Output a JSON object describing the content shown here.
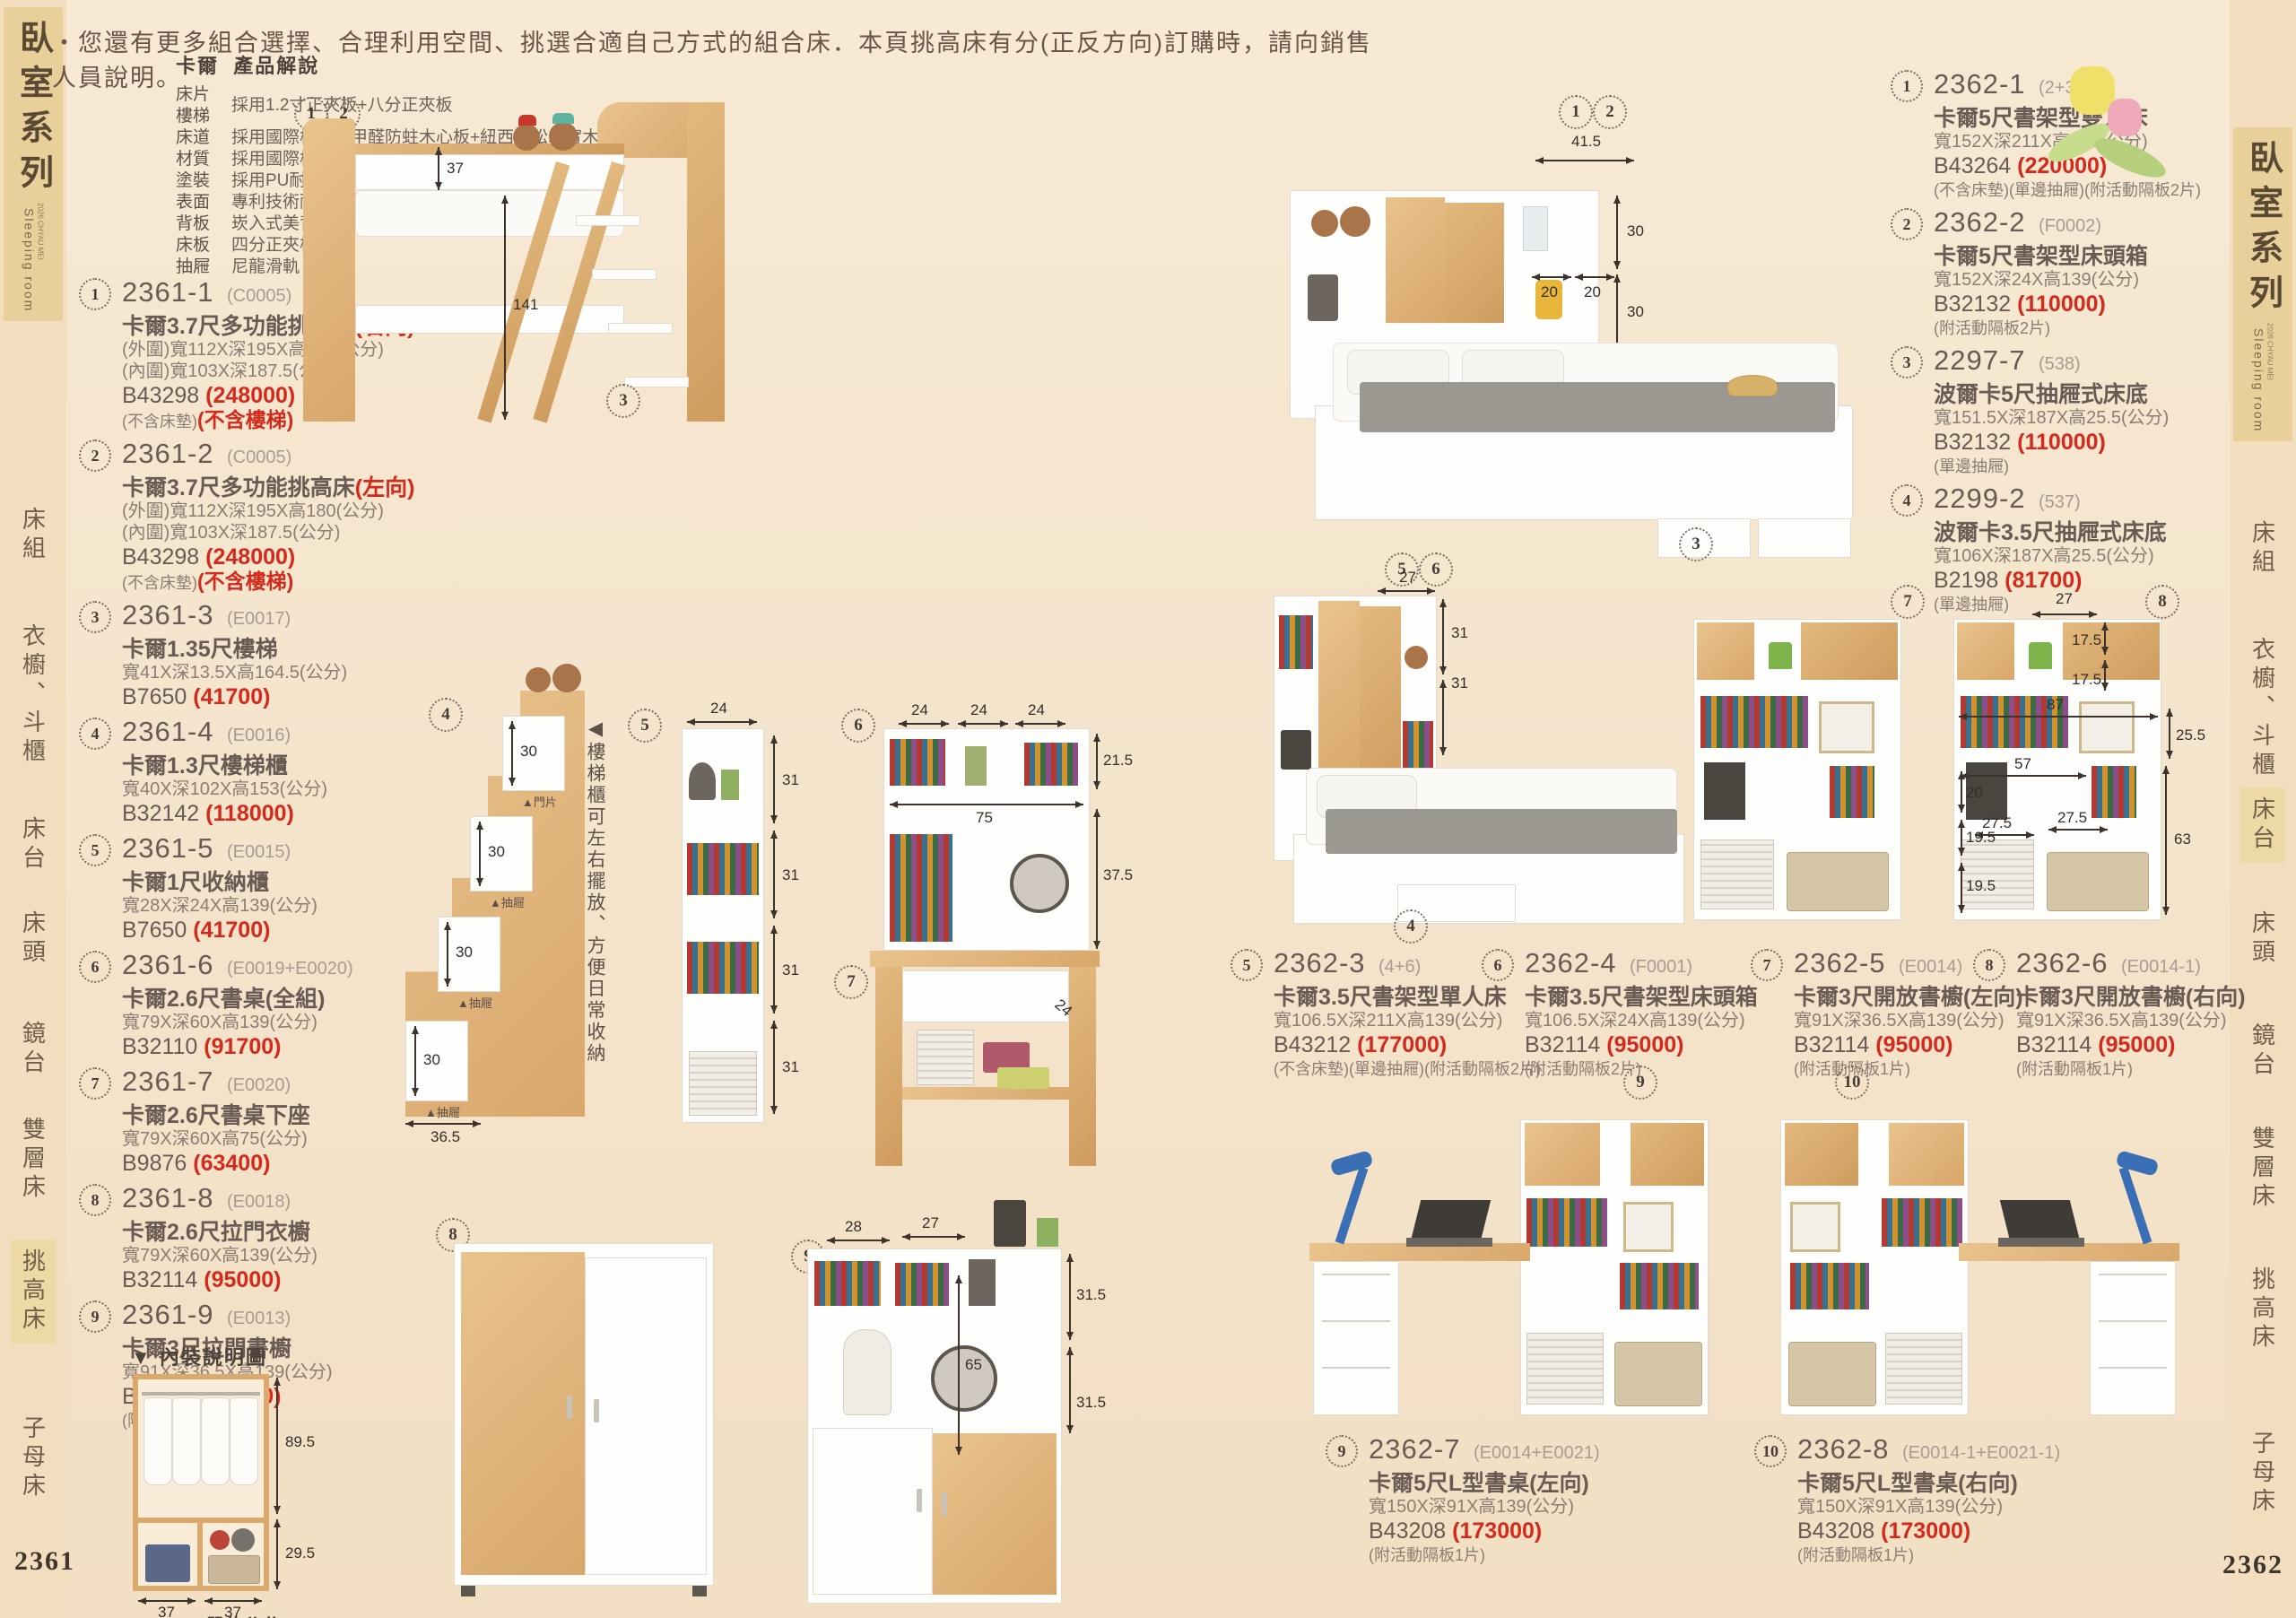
{
  "meta": {
    "header_note": "・您還有更多組合選擇、合理利用空間、挑選合適自己方式的組合床．本頁挑高床有分(正反方向)訂購時，請向銷售人員說明。",
    "page_left": "2361",
    "page_right": "2362"
  },
  "sidebar_left": {
    "series_title": "臥室系列",
    "series_subtitle": "Sleeping room",
    "series_edition": "2026 CHYAU MEI",
    "items": [
      "床組",
      "衣櫥、斗櫃",
      "床台",
      "床頭",
      "鏡台",
      "雙層床",
      "挑高床",
      "子母床"
    ],
    "active": "挑高床"
  },
  "sidebar_right": {
    "series_title": "臥室系列",
    "series_subtitle": "Sleeping room",
    "series_edition": "2026 CHYAU MEI",
    "items": [
      "床組",
      "衣櫥、斗櫃",
      "床台",
      "床頭",
      "鏡台",
      "雙層床",
      "挑高床",
      "子母床"
    ],
    "active": "床台"
  },
  "spec_block": {
    "brand": "卡爾",
    "title": "產品解說",
    "first_label_a": "床片",
    "first_label_b": "樓梯",
    "first_value": "採用1.2寸正夾板+八分正夾板",
    "rows": [
      {
        "label": "床道",
        "value": "採用國際標準低甲醛防蛀木心板+紐西蘭松木實木"
      },
      {
        "label": "材質",
        "value": "採用國際標準低甲醛防蛀木心板"
      },
      {
        "label": "塗裝",
        "value": "採用PU耐磨.耐水塗裝"
      },
      {
        "label": "表面",
        "value": "專利技術耐磨木紋同調浮雕壓紋.觸感猶如實木"
      },
      {
        "label": "背板",
        "value": "崁入式美背處理"
      },
      {
        "label": "床板",
        "value": "四分正夾板"
      },
      {
        "label": "抽屜",
        "value": "尼龍滑軌"
      }
    ]
  },
  "products_left": [
    {
      "num": "1",
      "code": "2361-1",
      "ref": "(C0005)",
      "name": "卡爾3.7尺多功能挑高床",
      "name_red": "(右向)",
      "dims": [
        "(外圍)寬112X深195X高180(公分)",
        "(內圍)寬103X深187.5(公分)"
      ],
      "sku": "B43298",
      "price": "(248000)",
      "note": "(不含床墊)",
      "note_red": "(不含樓梯)"
    },
    {
      "num": "2",
      "code": "2361-2",
      "ref": "(C0005)",
      "name": "卡爾3.7尺多功能挑高床",
      "name_red": "(左向)",
      "dims": [
        "(外圍)寬112X深195X高180(公分)",
        "(內圍)寬103X深187.5(公分)"
      ],
      "sku": "B43298",
      "price": "(248000)",
      "note": "(不含床墊)",
      "note_red": "(不含樓梯)"
    },
    {
      "num": "3",
      "code": "2361-3",
      "ref": "(E0017)",
      "name": "卡爾1.35尺樓梯",
      "dims": [
        "寬41X深13.5X高164.5(公分)"
      ],
      "sku": "B7650",
      "price": "(41700)"
    },
    {
      "num": "4",
      "code": "2361-4",
      "ref": "(E0016)",
      "name": "卡爾1.3尺樓梯櫃",
      "dims": [
        "寬40X深102X高153(公分)"
      ],
      "sku": "B32142",
      "price": "(118000)"
    },
    {
      "num": "5",
      "code": "2361-5",
      "ref": "(E0015)",
      "name": "卡爾1尺收納櫃",
      "dims": [
        "寬28X深24X高139(公分)"
      ],
      "sku": "B7650",
      "price": "(41700)"
    },
    {
      "num": "6",
      "code": "2361-6",
      "ref": "(E0019+E0020)",
      "name": "卡爾2.6尺書桌(全組)",
      "dims": [
        "寬79X深60X高139(公分)"
      ],
      "sku": "B32110",
      "price": "(91700)"
    },
    {
      "num": "7",
      "code": "2361-7",
      "ref": "(E0020)",
      "name": "卡爾2.6尺書桌下座",
      "dims": [
        "寬79X深60X高75(公分)"
      ],
      "sku": "B9876",
      "price": "(63400)"
    },
    {
      "num": "8",
      "code": "2361-8",
      "ref": "(E0018)",
      "name": "卡爾2.6尺拉門衣櫥",
      "dims": [
        "寬79X深60X高139(公分)"
      ],
      "sku": "B32114",
      "price": "(95000)"
    },
    {
      "num": "9",
      "code": "2361-9",
      "ref": "(E0013)",
      "name": "卡爾3尺拉門書櫥",
      "dims": [
        "寬91X深36.5X高139(公分)"
      ],
      "sku": "B32112",
      "price": "(93300)",
      "note": "(附活動隔板1片)"
    }
  ],
  "products_right": [
    {
      "num": "1",
      "code": "2362-1",
      "ref": "(2+3)",
      "name": "卡爾5尺書架型雙人床",
      "dims": [
        "寬152X深211X高139(公分)"
      ],
      "sku": "B43264",
      "price": "(220000)",
      "note": "(不含床墊)(單邊抽屜)(附活動隔板2片)"
    },
    {
      "num": "2",
      "code": "2362-2",
      "ref": "(F0002)",
      "name": "卡爾5尺書架型床頭箱",
      "dims": [
        "寬152X深24X高139(公分)"
      ],
      "sku": "B32132",
      "price": "(110000)",
      "note": "(附活動隔板2片)"
    },
    {
      "num": "3",
      "code": "2297-7",
      "ref": "(538)",
      "name": "波爾卡5尺抽屜式床底",
      "dims": [
        "寬151.5X深187X高25.5(公分)"
      ],
      "sku": "B32132",
      "price": "(110000)",
      "note": "(單邊抽屜)"
    },
    {
      "num": "4",
      "code": "2299-2",
      "ref": "(537)",
      "name": "波爾卡3.5尺抽屜式床底",
      "dims": [
        "寬106X深187X高25.5(公分)"
      ],
      "sku": "B2198",
      "price": "(81700)",
      "note": "(單邊抽屜)"
    }
  ],
  "products_mid": [
    {
      "num": "5",
      "code": "2362-3",
      "ref": "(4+6)",
      "name": "卡爾3.5尺書架型單人床",
      "dims": [
        "寬106.5X深211X高139(公分)"
      ],
      "sku": "B43212",
      "price": "(177000)",
      "note": "(不含床墊)(單邊抽屜)(附活動隔板2片)"
    },
    {
      "num": "6",
      "code": "2362-4",
      "ref": "(F0001)",
      "name": "卡爾3.5尺書架型床頭箱",
      "dims": [
        "寬106.5X深24X高139(公分)"
      ],
      "sku": "B32114",
      "price": "(95000)",
      "note": "(附活動隔板2片)"
    },
    {
      "num": "7",
      "code": "2362-5",
      "ref": "(E0014)",
      "name": "卡爾3尺開放書櫥(左向)",
      "dims": [
        "寬91X深36.5X高139(公分)"
      ],
      "sku": "B32114",
      "price": "(95000)",
      "note": "(附活動隔板1片)"
    },
    {
      "num": "8",
      "code": "2362-6",
      "ref": "(E0014-1)",
      "name": "卡爾3尺開放書櫥(右向)",
      "dims": [
        "寬91X深36.5X高139(公分)"
      ],
      "sku": "B32114",
      "price": "(95000)",
      "note": "(附活動隔板1片)"
    }
  ],
  "products_bottom": [
    {
      "num": "9",
      "code": "2362-7",
      "ref": "(E0014+E0021)",
      "name": "卡爾5尺L型書桌(左向)",
      "dims": [
        "寬150X深91X高139(公分)"
      ],
      "sku": "B43208",
      "price": "(173000)",
      "note": "(附活動隔板1片)"
    },
    {
      "num": "10",
      "code": "2362-8",
      "ref": "(E0014-1+E0021-1)",
      "name": "卡爾5尺L型書桌(右向)",
      "dims": [
        "寬150X深91X高139(公分)"
      ],
      "sku": "B43208",
      "price": "(173000)",
      "note": "(附活動隔板1片)"
    }
  ],
  "diagrams": {
    "loft": {
      "c1": "1",
      "c2": "2",
      "c3": "3",
      "d_top": "37",
      "d_side": "141"
    },
    "double_bed": {
      "c1": "1",
      "c2": "2",
      "c3": "3",
      "w": "41.5",
      "h1": "30",
      "w1": "20",
      "w2": "20",
      "h2": "30"
    },
    "single_bed": {
      "c5": "5",
      "c6": "6",
      "c4": "4",
      "w": "27",
      "h1": "31",
      "h2": "31"
    },
    "ladder_cab": {
      "c": "4",
      "s1": "30",
      "s2": "30",
      "s3": "30",
      "s4": "30",
      "l1": "▲門片",
      "l2": "▲抽屜",
      "l3": "▲抽屜",
      "l4": "▲抽屜",
      "w": "36.5",
      "note": "樓梯櫃可左右擺放、方便日常收納",
      "note_arrow": "◀"
    },
    "narrow_cab": {
      "c": "5",
      "w": "24",
      "r1": "31",
      "r2": "31",
      "r3": "31",
      "r4": "31"
    },
    "desk": {
      "c": "6",
      "c_low": "7",
      "t1": "24",
      "t2": "24",
      "t3": "24",
      "h1": "21.5",
      "w": "75",
      "h2": "37.5",
      "depth": "24"
    },
    "bookshelf_pair": {
      "c_left": "7",
      "c_right": "8",
      "top": "27",
      "h1": "17.5",
      "h2": "17.5",
      "w1": "87",
      "h3": "25.5",
      "w2": "57",
      "h4": "20",
      "w3": "27.5",
      "w4": "27.5",
      "h5": "19.5",
      "h6": "19.5",
      "side": "63"
    },
    "slide_wardrobe": {
      "c": "8"
    },
    "slide_bookcase": {
      "c": "9",
      "t1": "28",
      "t2": "27",
      "r1": "31.5",
      "mid": "65",
      "r2": "31.5"
    },
    "ldesk_left": {
      "c": "9"
    },
    "ldesk_right": {
      "c": "10"
    },
    "wardrobe_inner": {
      "marker": "▼",
      "header": "內裝說明圖",
      "h1": "89.5",
      "h2": "29.5",
      "w1": "37",
      "w2": "37",
      "unit": "[單位公分]"
    }
  }
}
